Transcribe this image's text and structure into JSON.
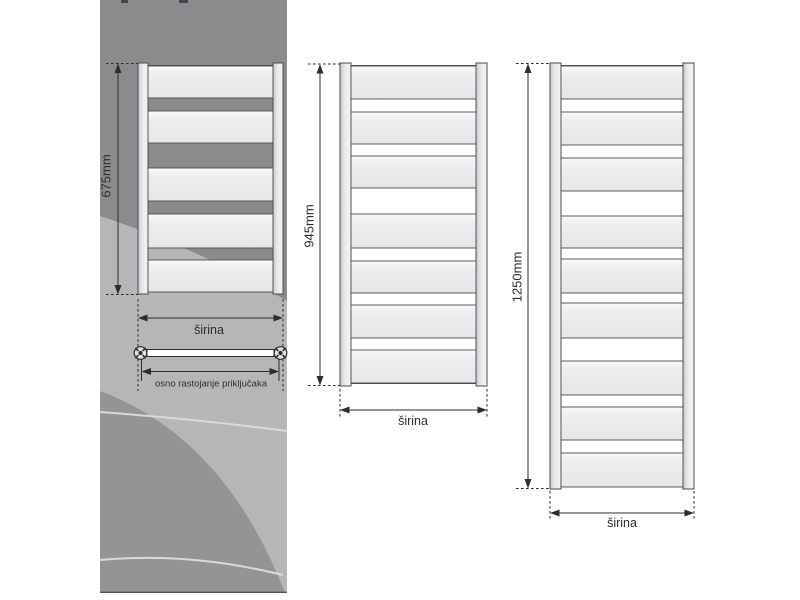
{
  "labels": {
    "width": "širina",
    "connection_spacing": "osno rastojanje priključaka"
  },
  "colors": {
    "page_bg": "#ffffff",
    "ink": "#2d2d2f",
    "swoosh_dark": "#8b8b8d",
    "swoosh_light": "#b5b6b8",
    "swoosh_blob": "#949496",
    "swoosh_arc": "#d8d9db",
    "panel_edge": "#57585a",
    "radiator_border": "#4a4d4f",
    "panel_fill_top": "#f8f9fa",
    "panel_fill_mid": "#eceef0",
    "panel_fill": "#e4e6e8",
    "rail_fill_a": "#c7c9cb",
    "rail_fill_b": "#f3f4f5",
    "valve_fill": "#dfe0e2"
  },
  "radiators": [
    {
      "height_label": "675mm",
      "width_label": "širina",
      "body": {
        "x": 138,
        "y": 63,
        "w": 145,
        "h": 231,
        "railW": 10
      },
      "panels": [
        [
          66,
          98
        ],
        [
          111,
          143
        ],
        [
          168,
          201
        ],
        [
          214,
          248
        ],
        [
          260,
          292
        ]
      ],
      "dim": {
        "x": 118,
        "y1": 63.5,
        "y2": 294.5,
        "label_cx": 106,
        "label_cy": 176
      },
      "width_arrow": {
        "y": 318,
        "x1": 138,
        "x2": 283,
        "dash_y1": 299,
        "dash_y2": 391,
        "label_cx": 209,
        "label_cy": 330
      },
      "pipe": {
        "bar_x1": 147,
        "bar_x2": 274,
        "y": 353,
        "valves": [
          140.5,
          280.5
        ]
      },
      "osno": {
        "label": "osno rastojanje priključaka",
        "y": 371.5,
        "x1": 141.5,
        "x2": 279,
        "tick_y1": 359,
        "tick_y2": 381,
        "label_cx": 211,
        "label_cy": 384
      }
    },
    {
      "height_label": "945mm",
      "width_label": "širina",
      "body": {
        "x": 340,
        "y": 63,
        "w": 147,
        "h": 323,
        "railW": 11
      },
      "panels": [
        [
          66,
          99
        ],
        [
          112,
          144
        ],
        [
          156,
          188
        ],
        [
          214,
          248
        ],
        [
          261,
          293
        ],
        [
          305,
          338
        ],
        [
          350,
          383
        ]
      ],
      "dim": {
        "x": 320,
        "y1": 64,
        "y2": 385.5,
        "label_cx": 309,
        "label_cy": 226
      },
      "width_arrow": {
        "y": 410,
        "x1": 340,
        "x2": 487,
        "dash_y1": 389,
        "dash_y2": 418,
        "label_cx": 413,
        "label_cy": 421
      }
    },
    {
      "height_label": "1250mm",
      "width_label": "širina",
      "body": {
        "x": 550,
        "y": 63,
        "w": 144,
        "h": 426,
        "railW": 11
      },
      "panels": [
        [
          66,
          99
        ],
        [
          112,
          145
        ],
        [
          158,
          191
        ],
        [
          216,
          248
        ],
        [
          259,
          293
        ],
        [
          303,
          338
        ],
        [
          361,
          395
        ],
        [
          407,
          440
        ],
        [
          453,
          487
        ]
      ],
      "dim": {
        "x": 528,
        "y1": 63.5,
        "y2": 488.5,
        "label_cx": 517,
        "label_cy": 277
      },
      "width_arrow": {
        "y": 513,
        "x1": 550,
        "x2": 694,
        "dash_y1": 491,
        "dash_y2": 521,
        "label_cx": 622,
        "label_cy": 523
      }
    }
  ]
}
